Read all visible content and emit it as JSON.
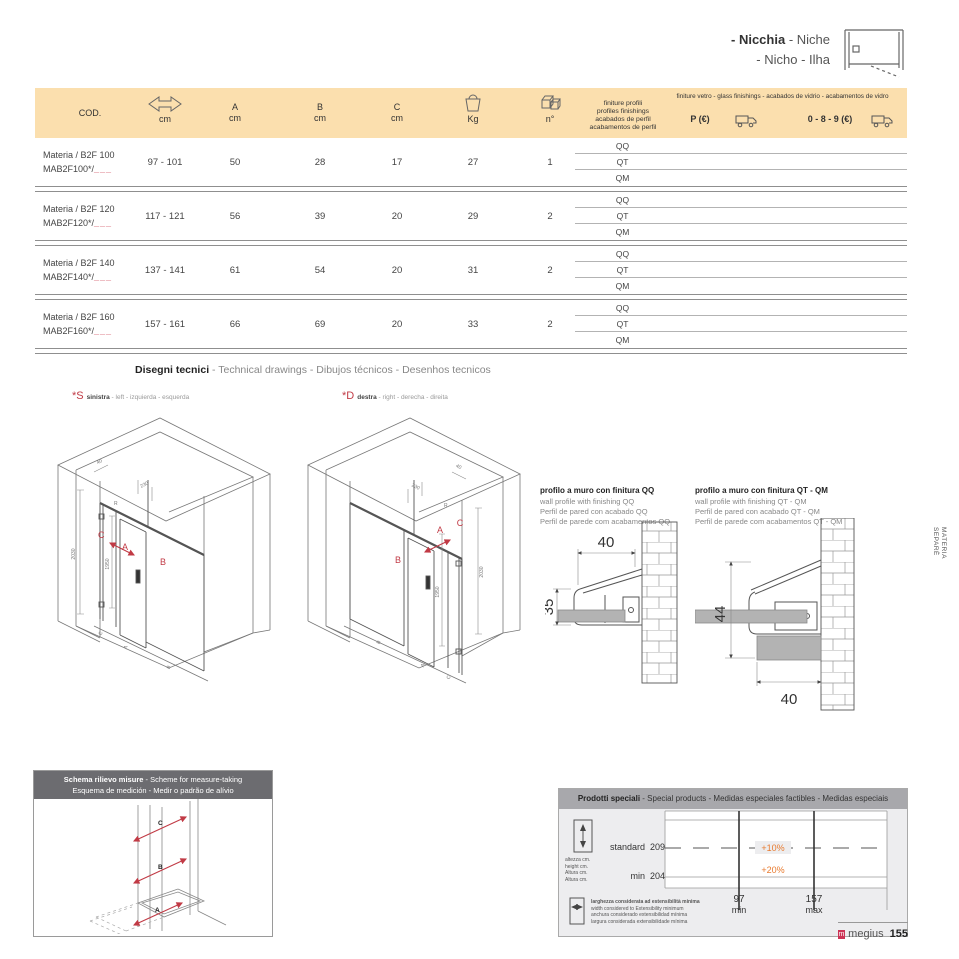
{
  "colors": {
    "accent_red": "#c13a45",
    "peach_header": "#fbdfae",
    "orange": "#e87a2e",
    "bar_dark": "#6c6c70",
    "bar_light": "#a8a8ac"
  },
  "icons": {
    "range": "double-arrow-icon",
    "weight": "weight-icon",
    "quantity": "packages-icon",
    "shipping": "truck-icon",
    "height": "height-arrow-icon",
    "width": "width-arrow-icon",
    "niche": "niche-plan-icon",
    "logo": "megius-logo"
  },
  "corner": {
    "title_it": "- Nicchia",
    "title_en": " - Niche",
    "title_line2": "- Nicho - Ilha"
  },
  "table": {
    "headers": {
      "cod": "COD.",
      "cm": "cm",
      "a": "A",
      "b": "B",
      "c": "C",
      "unit": "cm",
      "kg": "Kg",
      "n": "n°",
      "profiles_l1": "finiture profili",
      "profiles_l2": "profiles finishings",
      "profiles_l3": "acabados de perfil",
      "profiles_l4": "acabamentos de perfil",
      "glass": "finiture vetro - glass finishings - acabados de vidrio - acabamentos de vidro",
      "p_eur": "P (€)",
      "v089": "0 - 8 - 9 (€)"
    },
    "finishes": [
      "QQ",
      "QT",
      "QM"
    ],
    "rows": [
      {
        "name": "Materia / B2F 100",
        "code": "MAB2F100*/",
        "blanks": "___",
        "range": "97 - 101",
        "a": "50",
        "b": "28",
        "c": "17",
        "kg": "27",
        "n": "1"
      },
      {
        "name": "Materia / B2F 120",
        "code": "MAB2F120*/",
        "blanks": "___",
        "range": "117 - 121",
        "a": "56",
        "b": "39",
        "c": "20",
        "kg": "29",
        "n": "2"
      },
      {
        "name": "Materia / B2F 140",
        "code": "MAB2F140*/",
        "blanks": "___",
        "range": "137 - 141",
        "a": "61",
        "b": "54",
        "c": "20",
        "kg": "31",
        "n": "2"
      },
      {
        "name": "Materia / B2F 160",
        "code": "MAB2F160*/",
        "blanks": "___",
        "range": "157 - 161",
        "a": "66",
        "b": "69",
        "c": "20",
        "kg": "33",
        "n": "2"
      }
    ]
  },
  "tech": {
    "title_bold": "Disegni tecnici",
    "title_rest": " - Technical drawings - Dibujos técnicos - Desenhos tecnicos",
    "left": {
      "tag": "*S",
      "word": "sinistra",
      "rest": " - left - izquierda - esquerda"
    },
    "right": {
      "tag": "*D",
      "word": "destra",
      "rest": " - right - derecha - direita"
    },
    "dims": {
      "height": "2030",
      "inner_height": "1950",
      "bracket": "230",
      "profile": "40",
      "radius": "R",
      "panel_a": "A",
      "panel_b": "B",
      "panel_c": "C"
    }
  },
  "profiles": {
    "qq": {
      "title": "profilo a muro con finitura QQ",
      "en": "wall profile with finishing QQ",
      "es": "Perfil de pared con acabado QQ",
      "pt": "Perfil de parede com acabamentos QQ",
      "w": "40",
      "h": "35"
    },
    "qtqm": {
      "title": "profilo a muro con finitura QT - QM",
      "en": "wall profile with finishing QT - QM",
      "es": "Perfil de pared con acabado QT - QM",
      "pt": "Perfil de parede com acabamentos QT - QM",
      "h": "44",
      "w": "40"
    }
  },
  "schema": {
    "title_bold": "Schema rilievo misure",
    "title_rest": " - Scheme for measure-taking",
    "title2": "Esquema de medición - Medir o padrão de alívio",
    "labels": {
      "top": "C",
      "mid": "B",
      "bottom": "A"
    }
  },
  "special": {
    "title_bold": "Prodotti speciali",
    "title_rest": " - Special products  - Medidas especiales factibles - Medidas especiais",
    "height_lines": [
      "altezza cm.",
      "height cm.",
      "Altura cm.",
      "Altura cm."
    ],
    "standard_label": "standard",
    "standard_value": "209",
    "min_label": "min",
    "min_value": "204",
    "plus10": "+10%",
    "plus20": "+20%",
    "col_min_value": "97",
    "col_min_label": "min",
    "col_max_value": "157",
    "col_max_label": "max",
    "width_lines": [
      "larghezza considerata ad estensibilità minima",
      "width considered to Extensibility minimum",
      "anchura considerado extensibilidad mínima",
      "largura considerada extensibilidade mínima"
    ]
  },
  "side_label": {
    "l1": "MATERIA",
    "l2": "SEPARÈ"
  },
  "footer": {
    "brand": "megius",
    "page": "155"
  }
}
